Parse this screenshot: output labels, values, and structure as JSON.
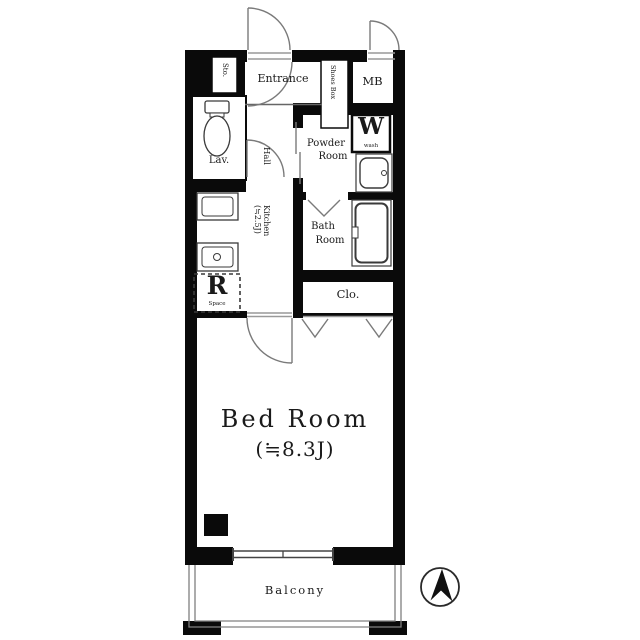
{
  "plan": {
    "type": "apartment-floor-plan",
    "rooms": {
      "storage": "Sto.",
      "entrance": "Entrance",
      "shoes_box": "Shoes Box",
      "meter_box": "MB",
      "lavatory": "Lav.",
      "hall": "Hall",
      "powder_room": {
        "line1": "Powder",
        "line2": "Room"
      },
      "washer": {
        "symbol": "W",
        "caption": "wash"
      },
      "bath_room": {
        "line1": "Bath",
        "line2": "Room"
      },
      "kitchen": {
        "line1": "Kitchen",
        "line2": "(≒2.5J)"
      },
      "refrigerator": {
        "symbol": "R",
        "caption": "Space"
      },
      "closet": "Clo.",
      "bed_room": {
        "line1": "Bed Room",
        "line2": "(≒8.3J)"
      },
      "balcony": "Balcony"
    },
    "colors": {
      "wall": "#0a0a0a",
      "fixture_line": "#3a3a3a",
      "door_line": "#7a7a7a",
      "threshold_line": "#999999",
      "text": "#1a1a1a",
      "background": "#ffffff"
    }
  }
}
